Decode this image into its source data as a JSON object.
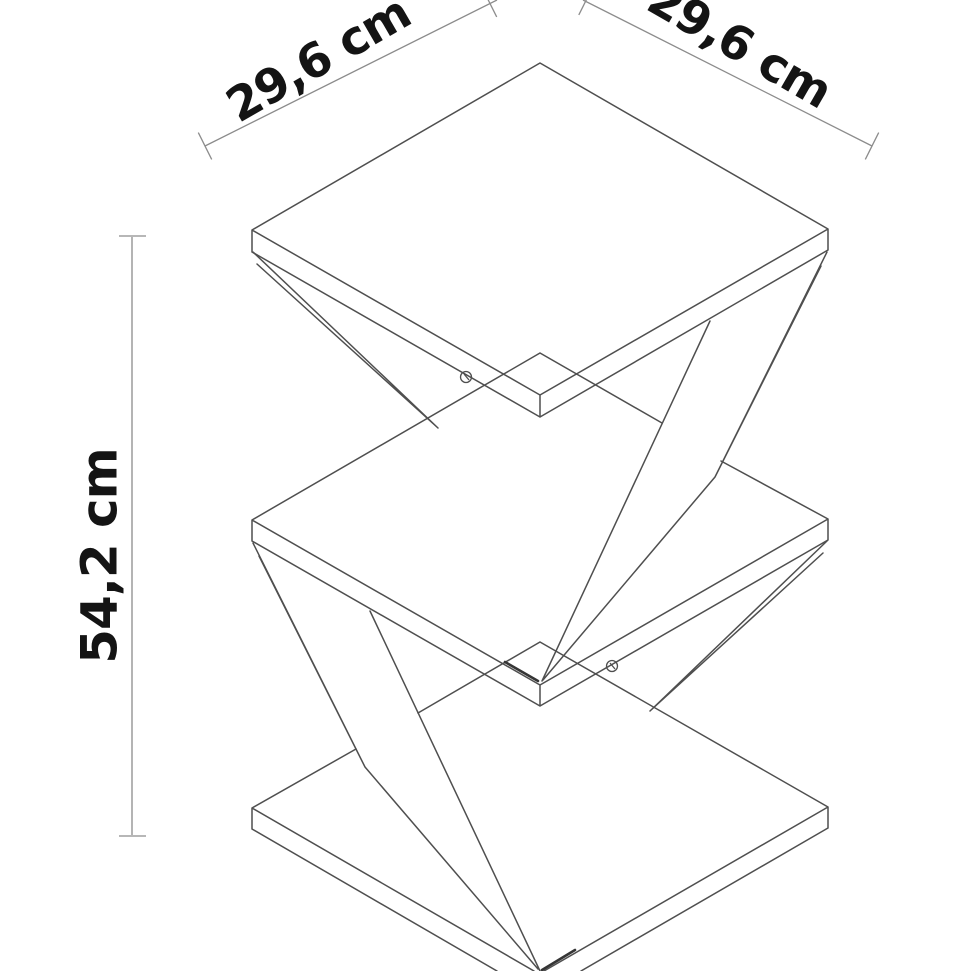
{
  "diagram": {
    "subject": "Z-shaped three-shelf side table, isometric technical line drawing",
    "dimensions": {
      "depth_label": "29,6 cm",
      "width_label": "29,6 cm",
      "height_label": "54,2 cm"
    }
  },
  "colors": {
    "background": "#ffffff",
    "line": "#4f4f4f",
    "accent_line": "#353535",
    "dimension_line": "#8c8c8c",
    "arrow": "#1a1a1a",
    "text": "#141414"
  }
}
